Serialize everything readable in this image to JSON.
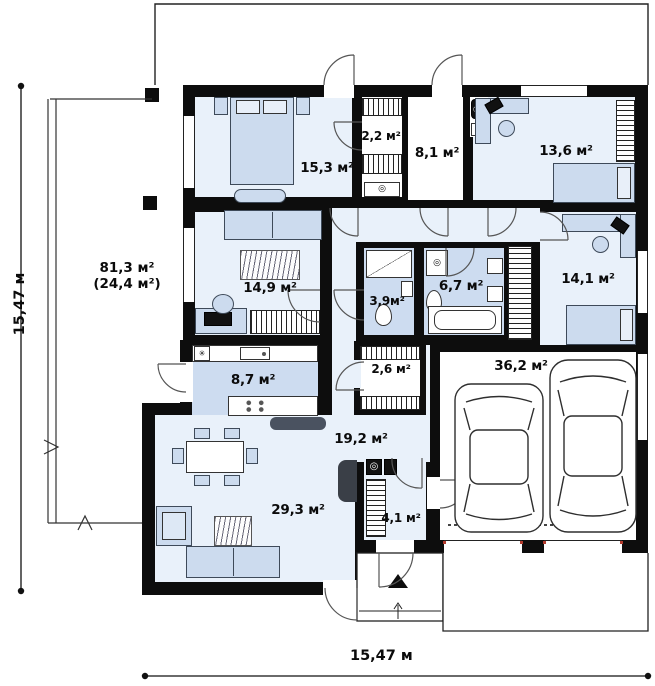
{
  "labels": {
    "dim_bottom": "15,47 м",
    "dim_left": "15,47 м",
    "terrace_line1": "81,3 м²",
    "terrace_line2": "(24,4 м²)"
  },
  "glyphs": {
    "round_appliance": "◎",
    "star_symbol": "✳"
  },
  "rooms": [
    {
      "name": "bedroom-master",
      "area": "15,3 м²"
    },
    {
      "name": "walk-in-closet",
      "area": "2,2 м²"
    },
    {
      "name": "hall-boiler-room",
      "area": "8,1 м²"
    },
    {
      "name": "bedroom-top-right",
      "area": "13,6 м²"
    },
    {
      "name": "family-room",
      "area": "14,9 м²"
    },
    {
      "name": "shower-room",
      "area": "3,9м²"
    },
    {
      "name": "bathroom",
      "area": "6,7 м²"
    },
    {
      "name": "bedroom-right",
      "area": "14,1 м²"
    },
    {
      "name": "kitchen",
      "area": "8,7 м²"
    },
    {
      "name": "closet",
      "area": "2,6 м²"
    },
    {
      "name": "hallway",
      "area": "19,2 м²"
    },
    {
      "name": "garage",
      "area": "36,2 м²"
    },
    {
      "name": "vestibule",
      "area": "4,1 м²"
    },
    {
      "name": "living-dining-room",
      "area": "29,3 м²"
    }
  ]
}
